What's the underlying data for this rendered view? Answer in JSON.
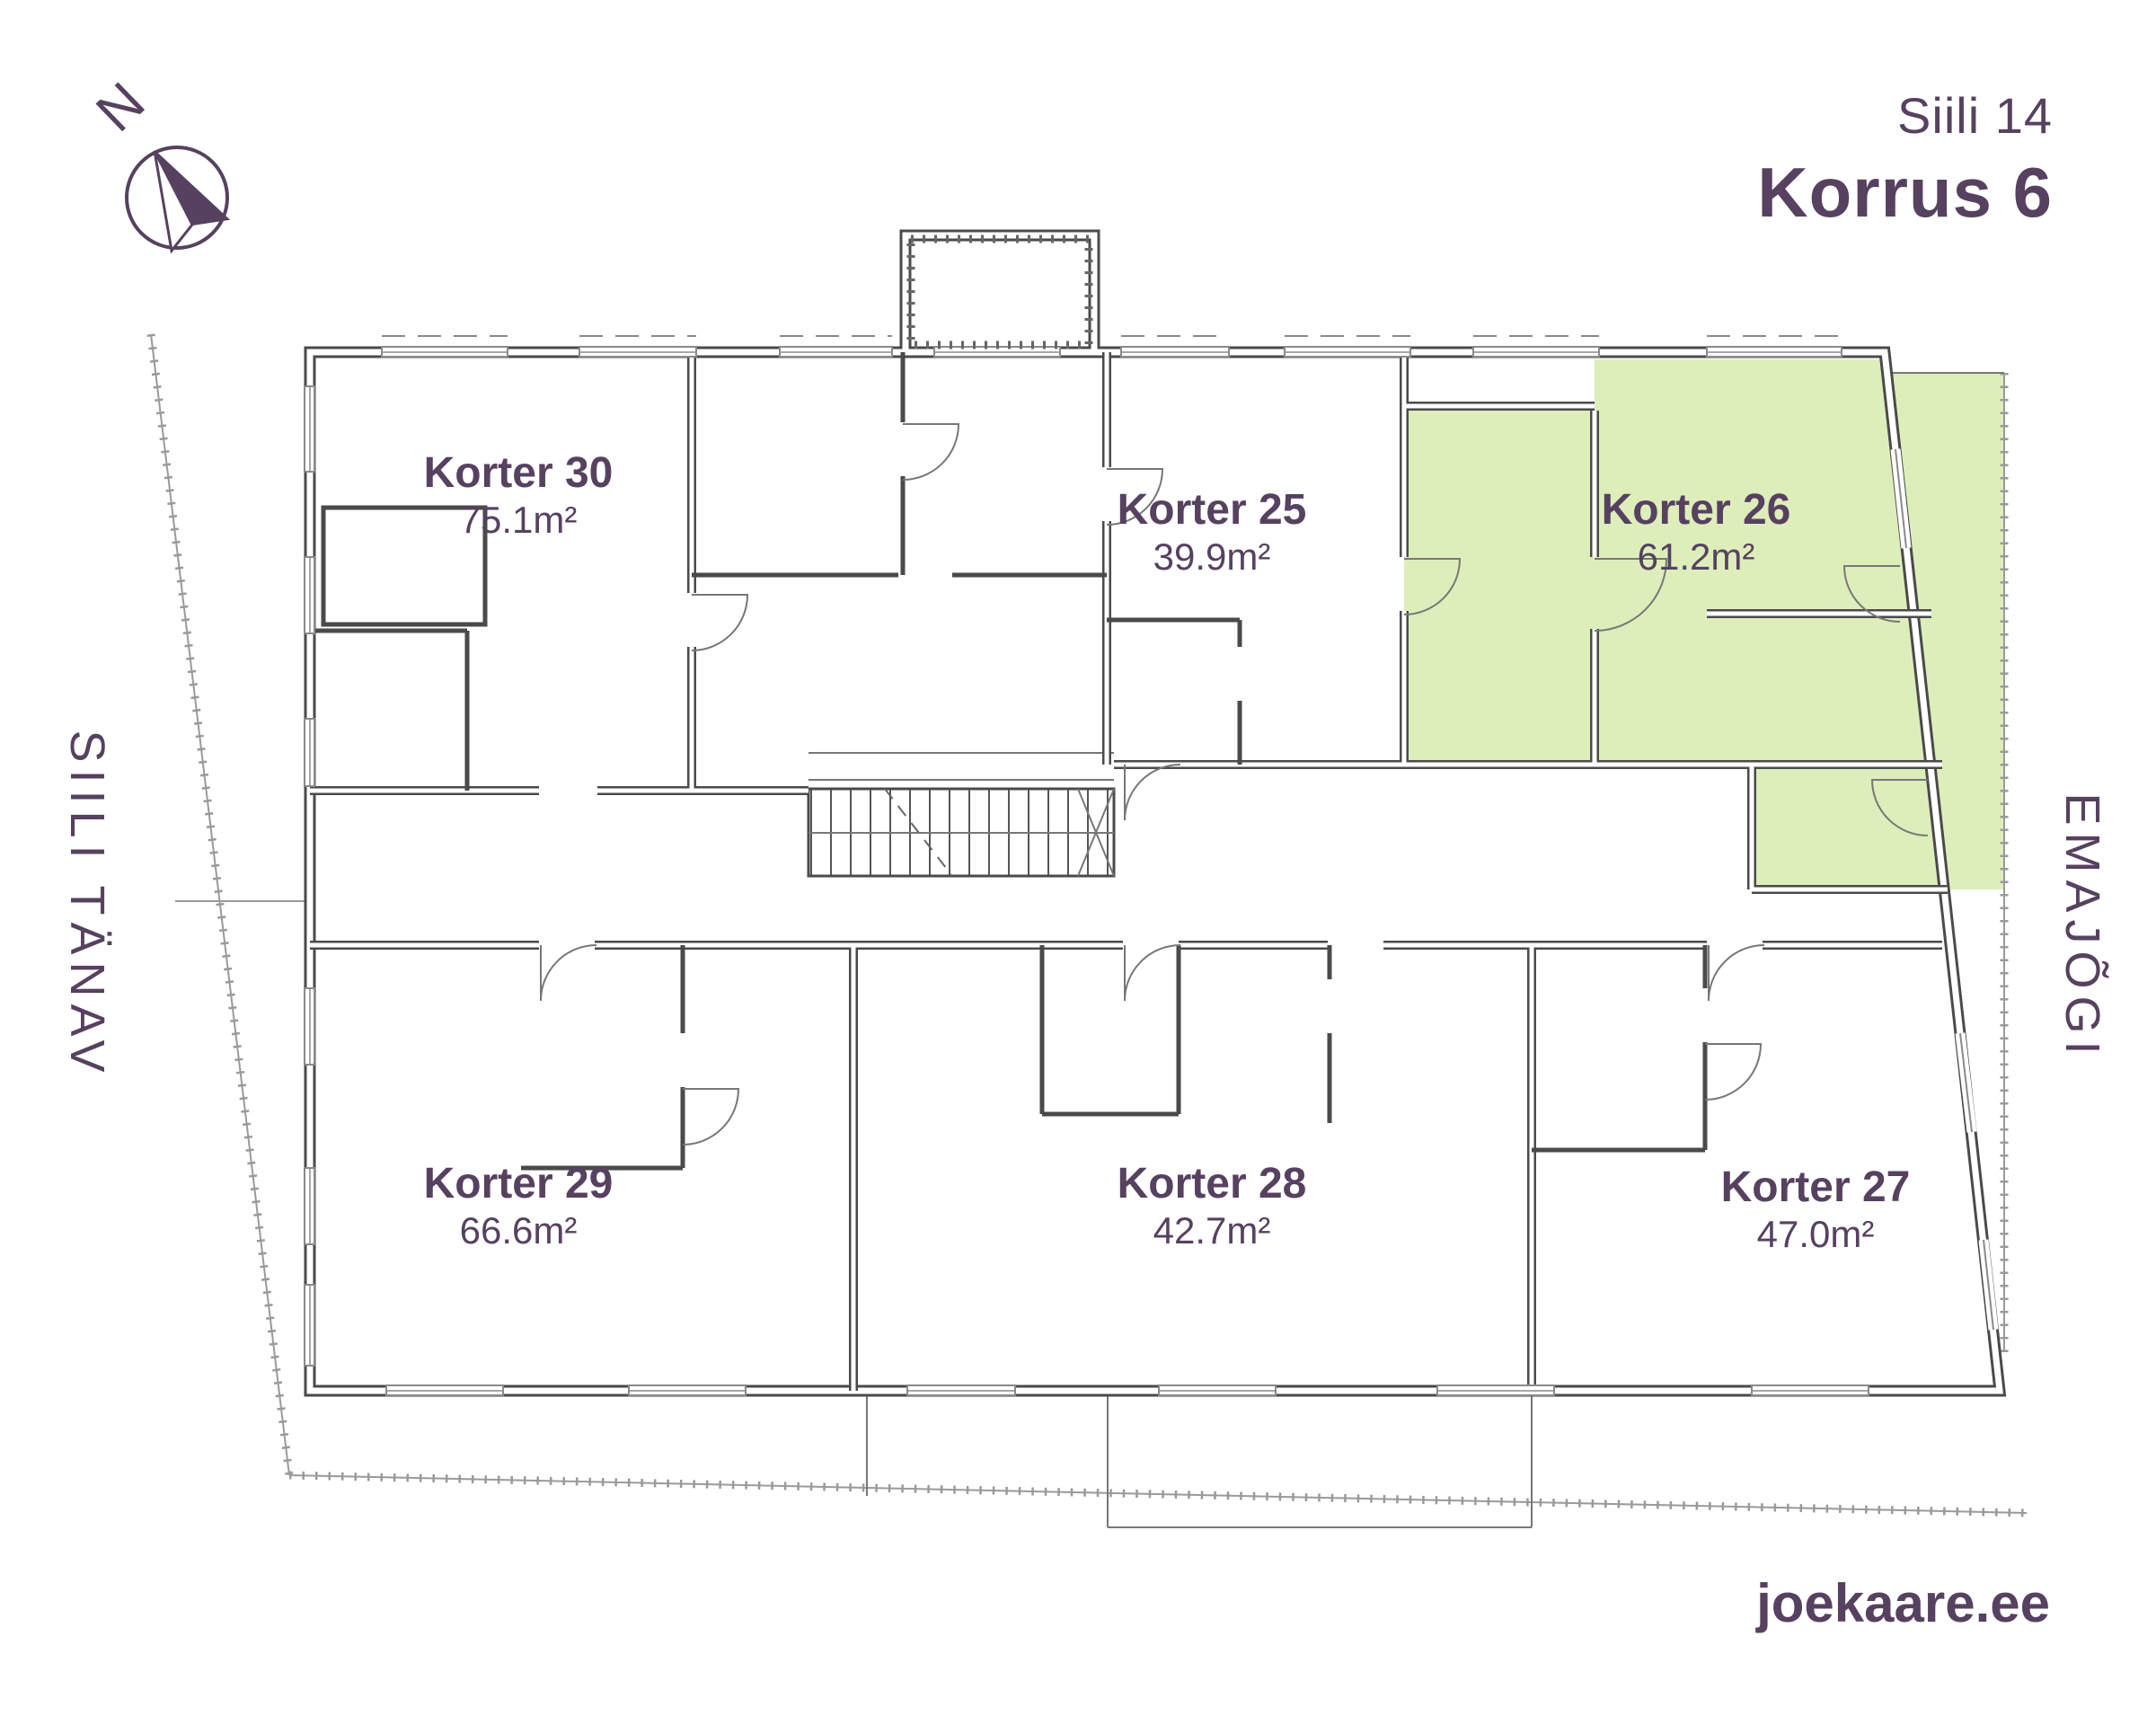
{
  "colors": {
    "accent": "#574160",
    "green": "#ddeebb",
    "wall": "#4a4a4a",
    "line": "#777777"
  },
  "header": {
    "address": "Siili 14",
    "floor": "Korrus 6"
  },
  "compass": {
    "label": "N"
  },
  "streets": {
    "left": "SIILI TÄNAV",
    "right": "EMAJÕGI"
  },
  "apartments": [
    {
      "id": "korter-30",
      "name": "Korter 30",
      "area": "75.1m²",
      "highlighted": false
    },
    {
      "id": "korter-25",
      "name": "Korter 25",
      "area": "39.9m²",
      "highlighted": false
    },
    {
      "id": "korter-26",
      "name": "Korter 26",
      "area": "61.2m²",
      "highlighted": true
    },
    {
      "id": "korter-29",
      "name": "Korter 29",
      "area": "66.6m²",
      "highlighted": false
    },
    {
      "id": "korter-28",
      "name": "Korter 28",
      "area": "42.7m²",
      "highlighted": false
    },
    {
      "id": "korter-27",
      "name": "Korter 27",
      "area": "47.0m²",
      "highlighted": false
    }
  ],
  "footer": {
    "website": "joekaare.ee"
  }
}
